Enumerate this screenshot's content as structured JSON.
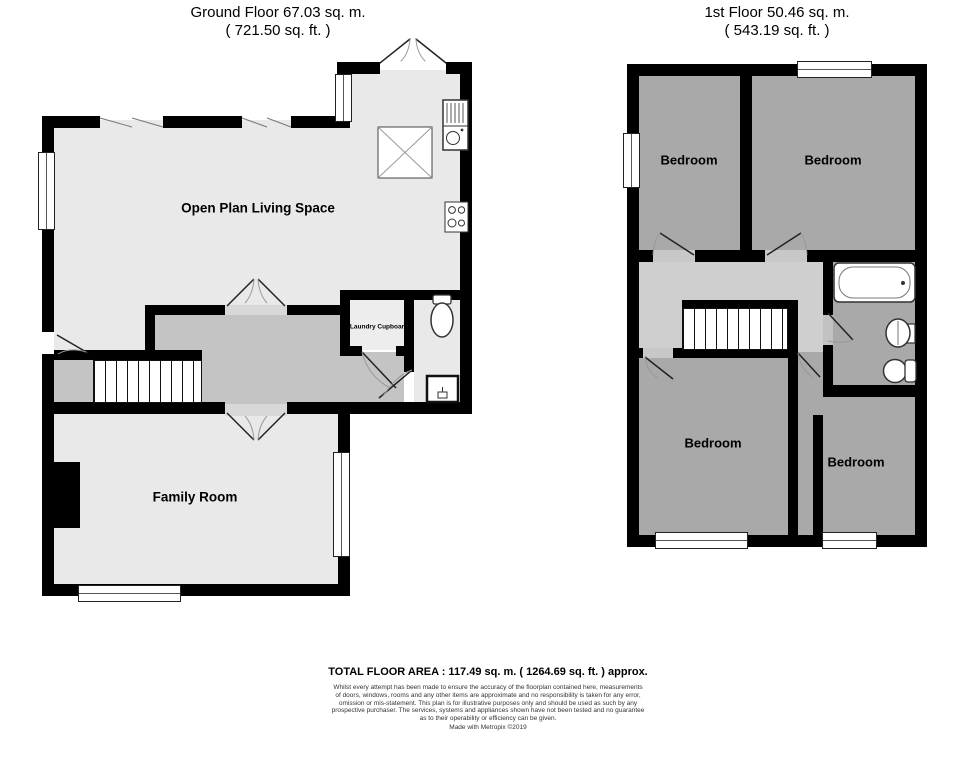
{
  "ground_floor": {
    "title": "Ground Floor 67.03 sq. m.",
    "subtitle": "( 721.50 sq. ft. )",
    "open_plan_label": "Open Plan Living Space",
    "family_room_label": "Family Room",
    "laundry_label": "Laundry Cupboard"
  },
  "first_floor": {
    "title": "1st Floor 50.46 sq. m.",
    "subtitle": "( 543.19 sq. ft. )",
    "bedroom_label": "Bedroom"
  },
  "footer": {
    "total_area": "TOTAL FLOOR AREA : 117.49 sq. m. ( 1264.69 sq. ft. ) approx.",
    "disclaimer_lines": [
      "Whilst every attempt has been made to ensure the accuracy of the floorplan contained here, measurements",
      "of doors, windows, rooms and any other items are approximate and no responsibility is taken for any error,",
      "omission or mis-statement. This plan is for illustrative purposes only and should be used as such by any",
      "prospective purchaser. The services, systems and appliances shown have not been tested and no guarantee",
      "as to their operability or efficiency can be given."
    ],
    "credit": "Made with Metropix ©2019"
  },
  "colors": {
    "wall": "#000000",
    "room_light": "#e9e9e9",
    "hall_mid": "#c4c4c4",
    "landing": "#cfcfcf",
    "room_dark": "#a9a9a9"
  }
}
